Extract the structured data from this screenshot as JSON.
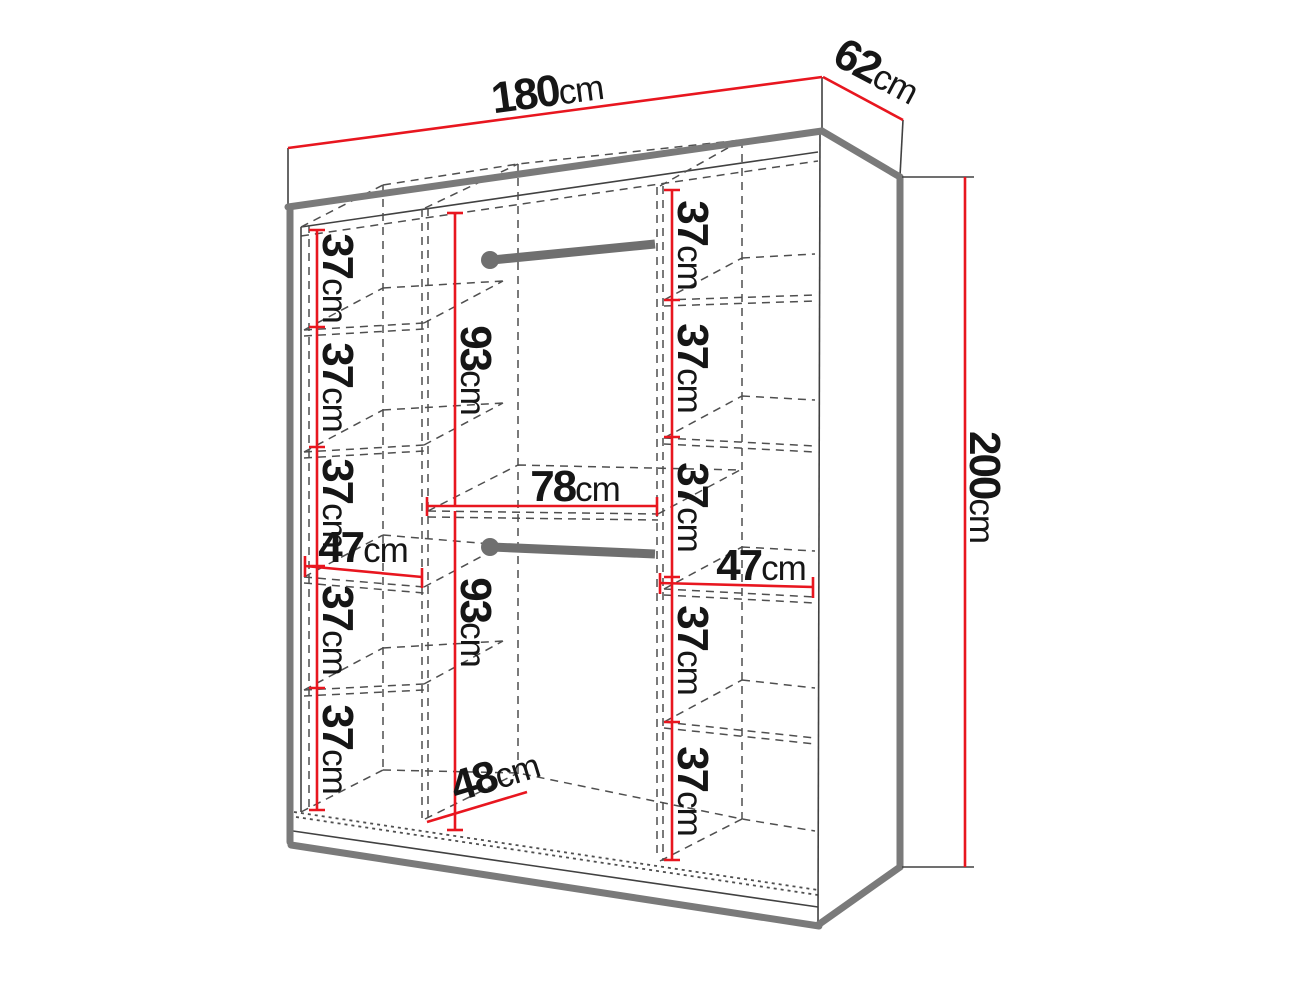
{
  "labels": {
    "width": {
      "num": "180",
      "unit": "cm"
    },
    "depth": {
      "num": "62",
      "unit": "cm"
    },
    "height": {
      "num": "200",
      "unit": "cm"
    },
    "left_gaps": [
      {
        "num": "37",
        "unit": "cm"
      },
      {
        "num": "37",
        "unit": "cm"
      },
      {
        "num": "37",
        "unit": "cm"
      },
      {
        "num": "37",
        "unit": "cm"
      },
      {
        "num": "37",
        "unit": "cm"
      }
    ],
    "right_gaps": [
      {
        "num": "37",
        "unit": "cm"
      },
      {
        "num": "37",
        "unit": "cm"
      },
      {
        "num": "37",
        "unit": "cm"
      },
      {
        "num": "37",
        "unit": "cm"
      },
      {
        "num": "37",
        "unit": "cm"
      }
    ],
    "left_shelf_width": {
      "num": "47",
      "unit": "cm"
    },
    "right_shelf_width": {
      "num": "47",
      "unit": "cm"
    },
    "mid_upper_hanging": {
      "num": "93",
      "unit": "cm"
    },
    "mid_lower_hanging": {
      "num": "93",
      "unit": "cm"
    },
    "mid_width": {
      "num": "78",
      "unit": "cm"
    },
    "mid_depth": {
      "num": "48",
      "unit": "cm"
    }
  },
  "colors": {
    "dimension_red": "#e8161f",
    "edge_gray": "#7a7a7a",
    "line_dark": "#414141",
    "text": "#161616"
  }
}
